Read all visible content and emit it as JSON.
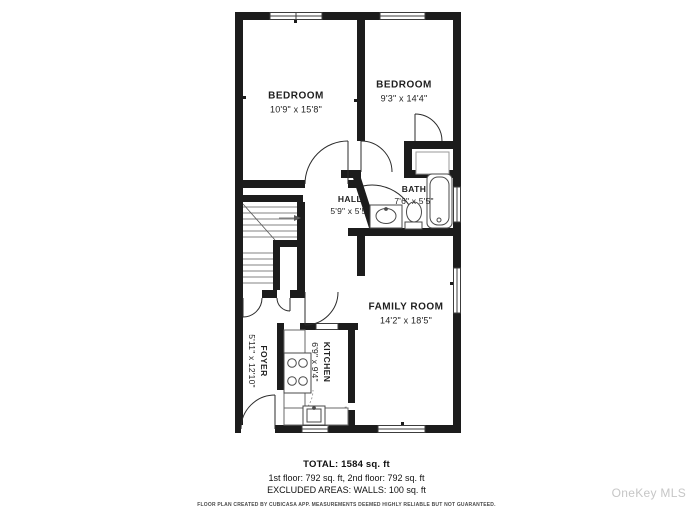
{
  "rooms": {
    "bedroom1": {
      "name": "BEDROOM",
      "dims": "10'9\" x 15'8\""
    },
    "bedroom2": {
      "name": "BEDROOM",
      "dims": "9'3\" x 14'4\""
    },
    "hall": {
      "name": "HALL",
      "dims": "5'9\" x 5'5\""
    },
    "bath": {
      "name": "BATH",
      "dims": "7'6\" x 5'5\""
    },
    "family_room": {
      "name": "FAMILY ROOM",
      "dims": "14'2\" x 18'5\""
    },
    "kitchen": {
      "name": "KITCHEN",
      "dims": "6'9\" x 9'4\""
    },
    "foyer": {
      "name": "FOYER",
      "dims": "5'11\" x 12'10\""
    }
  },
  "summary": {
    "total": "TOTAL: 1584 sq. ft",
    "floors": "1st floor: 792 sq. ft, 2nd floor: 792 sq. ft",
    "excluded": "EXCLUDED AREAS: WALLS: 100 sq. ft",
    "disclaimer": "FLOOR PLAN CREATED BY CUBICASA APP. MEASUREMENTS DEEMED HIGHLY RELIABLE BUT NOT GUARANTEED."
  },
  "watermark": "OneKey MLS",
  "colors": {
    "wall": "#1c1c1c",
    "fixture_line": "#4a4a4a",
    "stair_line": "#5a5a5a",
    "watermark": "#c6c6c6"
  }
}
